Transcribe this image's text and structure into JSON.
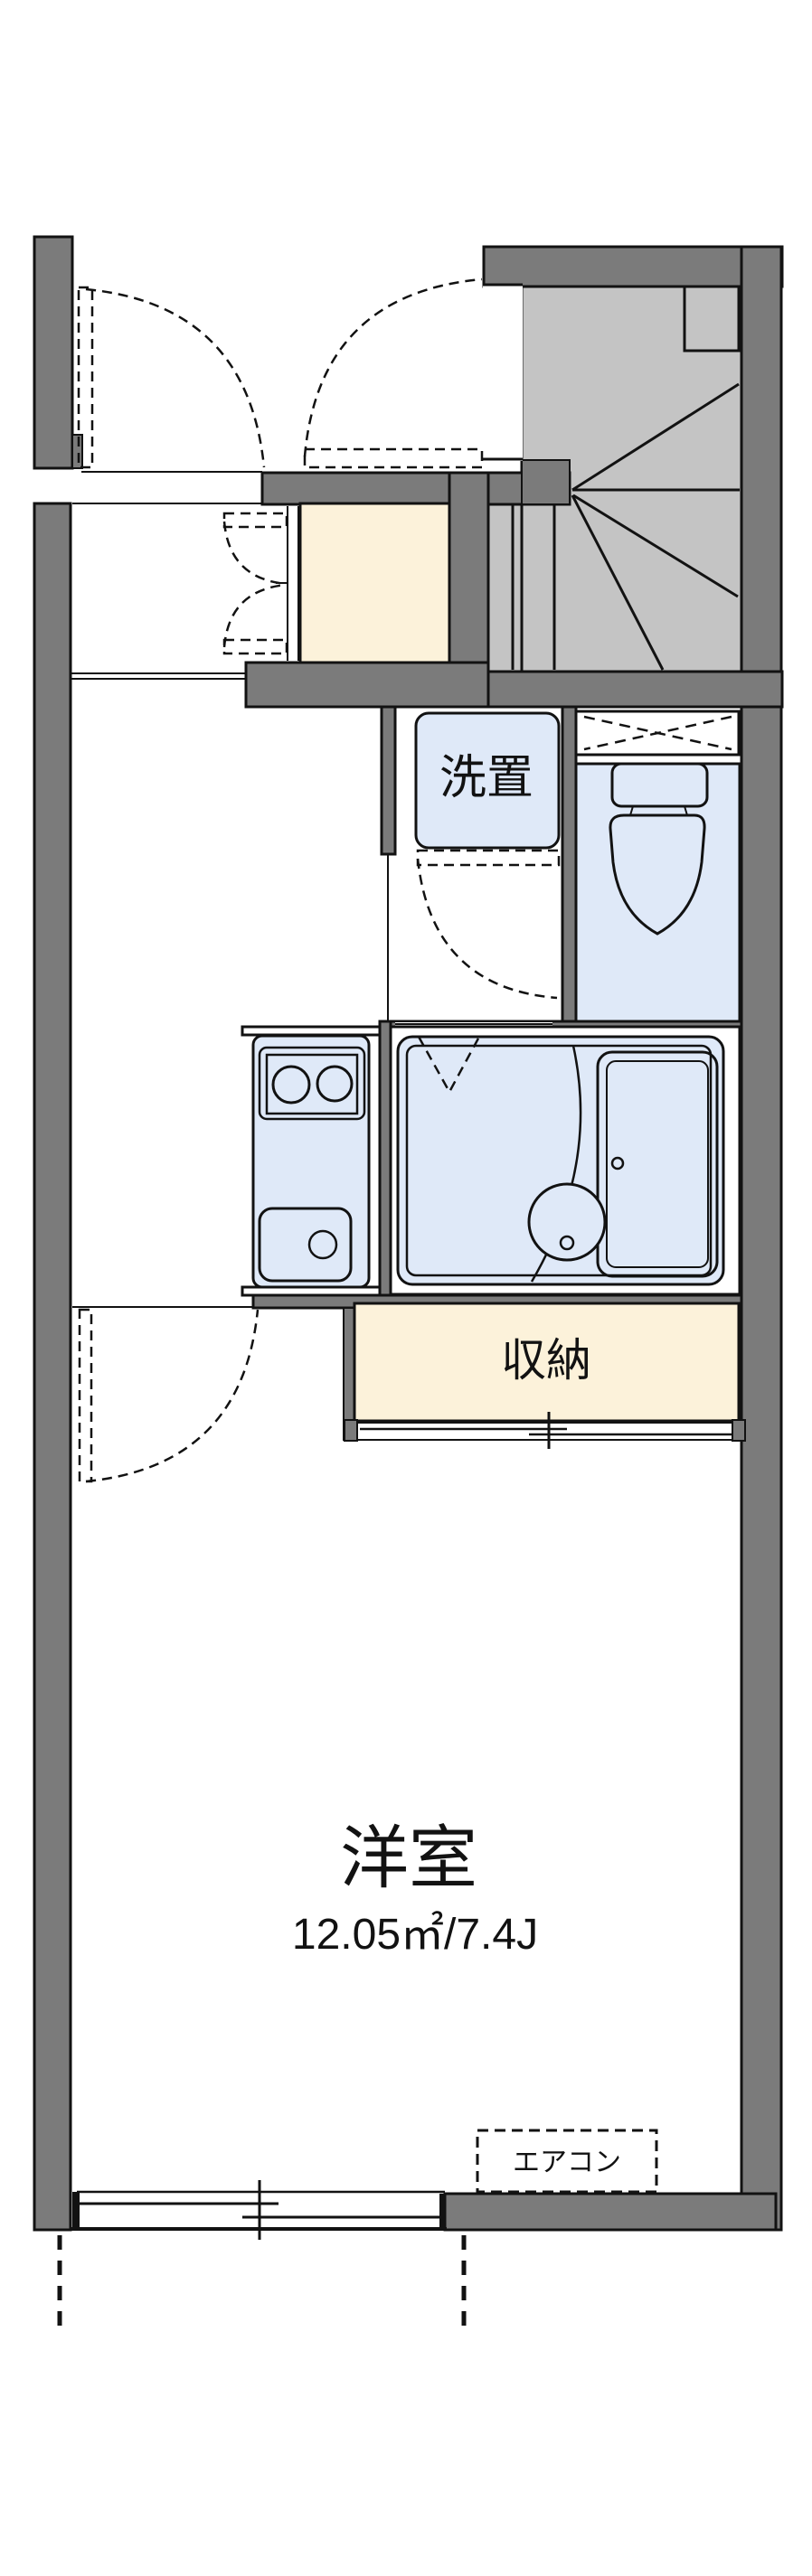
{
  "plan": {
    "title": "1K apartment floor plan",
    "labels": {
      "laundry": "洗置",
      "storage": "収納",
      "main_room": "洋室",
      "main_room_area": "12.05㎡/7.4J",
      "aircon": "エアコン"
    },
    "colors": {
      "wall": "#7b7b7b",
      "stair": "#c4c4c4",
      "water": "#dfe9f8",
      "cream": "#fcf2da",
      "line": "#121212",
      "bg": "#ffffff"
    }
  }
}
